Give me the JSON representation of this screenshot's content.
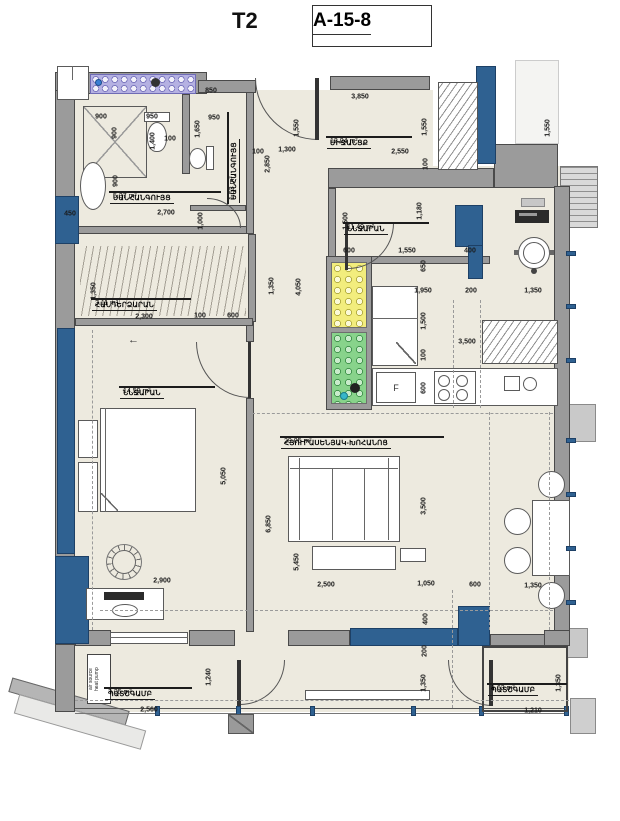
{
  "header": {
    "unit_type": "T2",
    "unit_code": "A-15-8"
  },
  "annotations": {
    "fridge_label": "F",
    "heat_pump_line1": "air source",
    "heat_pump_line2": "heat pump",
    "entry_arrow": "←"
  },
  "colors": {
    "wall": "#9b9b9b",
    "structural_column": "#2f6191",
    "floor": "#edeadf",
    "shaft_yellow": "#f2ed7d",
    "shaft_green": "#88d38b",
    "washer_strip": "#b5b1e2"
  },
  "rooms": [
    {
      "name": "ՍԱՆՀԱՆԳՈՒՅՑ",
      "area": "5.37 m²",
      "x": 165,
      "y": 192,
      "w": 112,
      "vertical": false
    },
    {
      "name": "ՍԱՆՀԱՆԳՈՒՅՑ",
      "area": "1.53 m²",
      "x": 228,
      "y": 158,
      "w": 92,
      "vertical": true
    },
    {
      "name": "ՄԻՋԱՆՑՔ",
      "area": "12.04 m²",
      "x": 369,
      "y": 137,
      "w": 86,
      "vertical": false
    },
    {
      "name": "ՆՆՋԱՐԱՆ",
      "area": "11.49 m²",
      "x": 386,
      "y": 223,
      "w": 86,
      "vertical": false
    },
    {
      "name": "ՀԱՆԴԵՐՁԱՐԱՆ",
      "area": "3.11 m²",
      "x": 141,
      "y": 299,
      "w": 100,
      "vertical": false
    },
    {
      "name": "ՆՆՋԱՐԱՆ",
      "area": "14.59 m²",
      "x": 167,
      "y": 387,
      "w": 96,
      "vertical": false
    },
    {
      "name": "ՀՅՈՒՐԱՍԵՆՅԱԿ-ԽՈՀԱՆՈՑ",
      "area": "29.05 m²",
      "x": 362,
      "y": 437,
      "w": 164,
      "vertical": false
    },
    {
      "name": "ՊԱՏՇԳԱՄԲ",
      "area": "3.35 m²",
      "x": 148,
      "y": 688,
      "w": 88,
      "vertical": false
    },
    {
      "name": "ՊԱՏՇԳԱՄԲ",
      "area": "1.63 m²",
      "x": 527,
      "y": 684,
      "w": 80,
      "vertical": false
    }
  ],
  "dimensions": [
    {
      "t": "850",
      "x": 211,
      "y": 91
    },
    {
      "t": "900",
      "x": 101,
      "y": 117
    },
    {
      "t": "950",
      "x": 152,
      "y": 117
    },
    {
      "t": "950",
      "x": 214,
      "y": 118
    },
    {
      "t": "900",
      "x": 115,
      "y": 133,
      "v": 1
    },
    {
      "t": "1,400",
      "x": 153,
      "y": 141,
      "v": 1
    },
    {
      "t": "100",
      "x": 170,
      "y": 139
    },
    {
      "t": "1,650",
      "x": 198,
      "y": 129,
      "v": 1
    },
    {
      "t": "900",
      "x": 116,
      "y": 181,
      "v": 1
    },
    {
      "t": "450",
      "x": 70,
      "y": 214
    },
    {
      "t": "2,700",
      "x": 166,
      "y": 213
    },
    {
      "t": "1,000",
      "x": 201,
      "y": 221,
      "v": 1
    },
    {
      "t": "3,850",
      "x": 360,
      "y": 97
    },
    {
      "t": "1,550",
      "x": 297,
      "y": 128,
      "v": 1
    },
    {
      "t": "1,550",
      "x": 425,
      "y": 127,
      "v": 1
    },
    {
      "t": "100",
      "x": 258,
      "y": 152
    },
    {
      "t": "1,300",
      "x": 287,
      "y": 150
    },
    {
      "t": "2,550",
      "x": 400,
      "y": 152
    },
    {
      "t": "2,850",
      "x": 268,
      "y": 164,
      "v": 1
    },
    {
      "t": "100",
      "x": 426,
      "y": 164,
      "v": 1
    },
    {
      "t": "1,550",
      "x": 548,
      "y": 128,
      "v": 1
    },
    {
      "t": "1,500",
      "x": 346,
      "y": 221,
      "v": 1
    },
    {
      "t": "1,180",
      "x": 420,
      "y": 211,
      "v": 1
    },
    {
      "t": "600",
      "x": 349,
      "y": 251
    },
    {
      "t": "1,550",
      "x": 407,
      "y": 251
    },
    {
      "t": "400",
      "x": 470,
      "y": 251
    },
    {
      "t": "650",
      "x": 424,
      "y": 266,
      "v": 1
    },
    {
      "t": "1,950",
      "x": 423,
      "y": 291
    },
    {
      "t": "200",
      "x": 471,
      "y": 291
    },
    {
      "t": "1,350",
      "x": 533,
      "y": 291
    },
    {
      "t": "1,350",
      "x": 94,
      "y": 291,
      "v": 1
    },
    {
      "t": "2,300",
      "x": 144,
      "y": 317
    },
    {
      "t": "100",
      "x": 200,
      "y": 316
    },
    {
      "t": "600",
      "x": 233,
      "y": 316
    },
    {
      "t": "1,350",
      "x": 272,
      "y": 286,
      "v": 1
    },
    {
      "t": "4,050",
      "x": 299,
      "y": 287,
      "v": 1
    },
    {
      "t": "1,500",
      "x": 424,
      "y": 321,
      "v": 1
    },
    {
      "t": "3,500",
      "x": 467,
      "y": 342
    },
    {
      "t": "100",
      "x": 424,
      "y": 355,
      "v": 1
    },
    {
      "t": "600",
      "x": 424,
      "y": 388,
      "v": 1
    },
    {
      "t": "5,050",
      "x": 224,
      "y": 476,
      "v": 1
    },
    {
      "t": "6,850",
      "x": 269,
      "y": 524,
      "v": 1
    },
    {
      "t": "5,450",
      "x": 297,
      "y": 562,
      "v": 1
    },
    {
      "t": "3,500",
      "x": 424,
      "y": 506,
      "v": 1
    },
    {
      "t": "2,900",
      "x": 162,
      "y": 581
    },
    {
      "t": "2,500",
      "x": 326,
      "y": 585
    },
    {
      "t": "1,050",
      "x": 426,
      "y": 584
    },
    {
      "t": "600",
      "x": 475,
      "y": 585
    },
    {
      "t": "1,350",
      "x": 533,
      "y": 586
    },
    {
      "t": "400",
      "x": 426,
      "y": 619,
      "v": 1
    },
    {
      "t": "200",
      "x": 425,
      "y": 651,
      "v": 1
    },
    {
      "t": "1,350",
      "x": 424,
      "y": 683,
      "v": 1
    },
    {
      "t": "1,240",
      "x": 209,
      "y": 677,
      "v": 1
    },
    {
      "t": "2,560",
      "x": 149,
      "y": 710
    },
    {
      "t": "1,210",
      "x": 533,
      "y": 711
    },
    {
      "t": "1,350",
      "x": 559,
      "y": 683,
      "v": 1
    }
  ]
}
